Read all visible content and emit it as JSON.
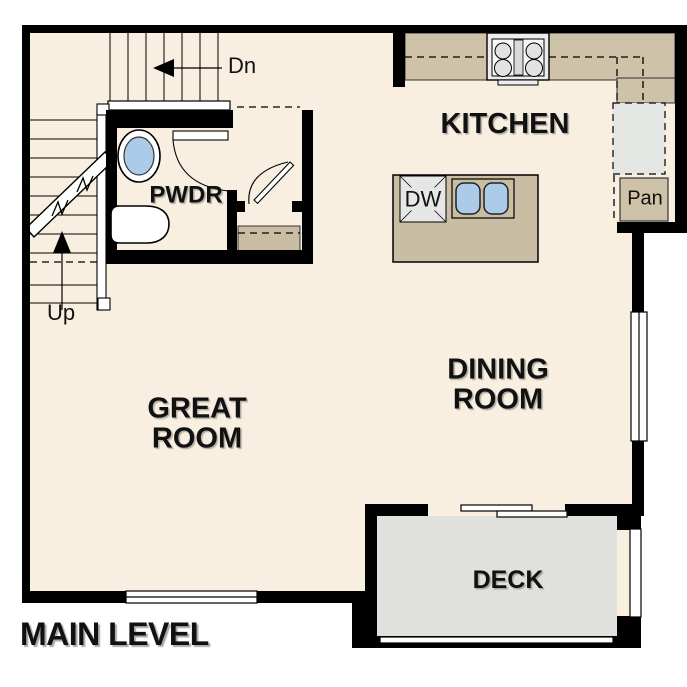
{
  "plan_title": "MAIN LEVEL",
  "rooms": {
    "kitchen": {
      "label": "KITCHEN"
    },
    "powder_room": {
      "label": "PWDR"
    },
    "great_room": {
      "line1": "GREAT",
      "line2": "ROOM"
    },
    "dining_room": {
      "line1": "DINING",
      "line2": "ROOM"
    },
    "deck": {
      "label": "DECK"
    },
    "pantry": {
      "label": "Pan"
    }
  },
  "appliances": {
    "dishwasher": {
      "label": "DW"
    }
  },
  "stairs": {
    "down_label": "Dn",
    "up_label": "Up"
  },
  "colors": {
    "wall": "#000000",
    "floor": "#f8efe1",
    "counter_tan": "#cec2a9",
    "island_tan": "#c9bda4",
    "closet_shelf_tan": "#c9bda4",
    "deck_gray": "#e0e0dd",
    "appliance_gray": "#ececec",
    "refrigerator_gray": "#e4e6e4",
    "sink_blue": "#abcbe9"
  }
}
